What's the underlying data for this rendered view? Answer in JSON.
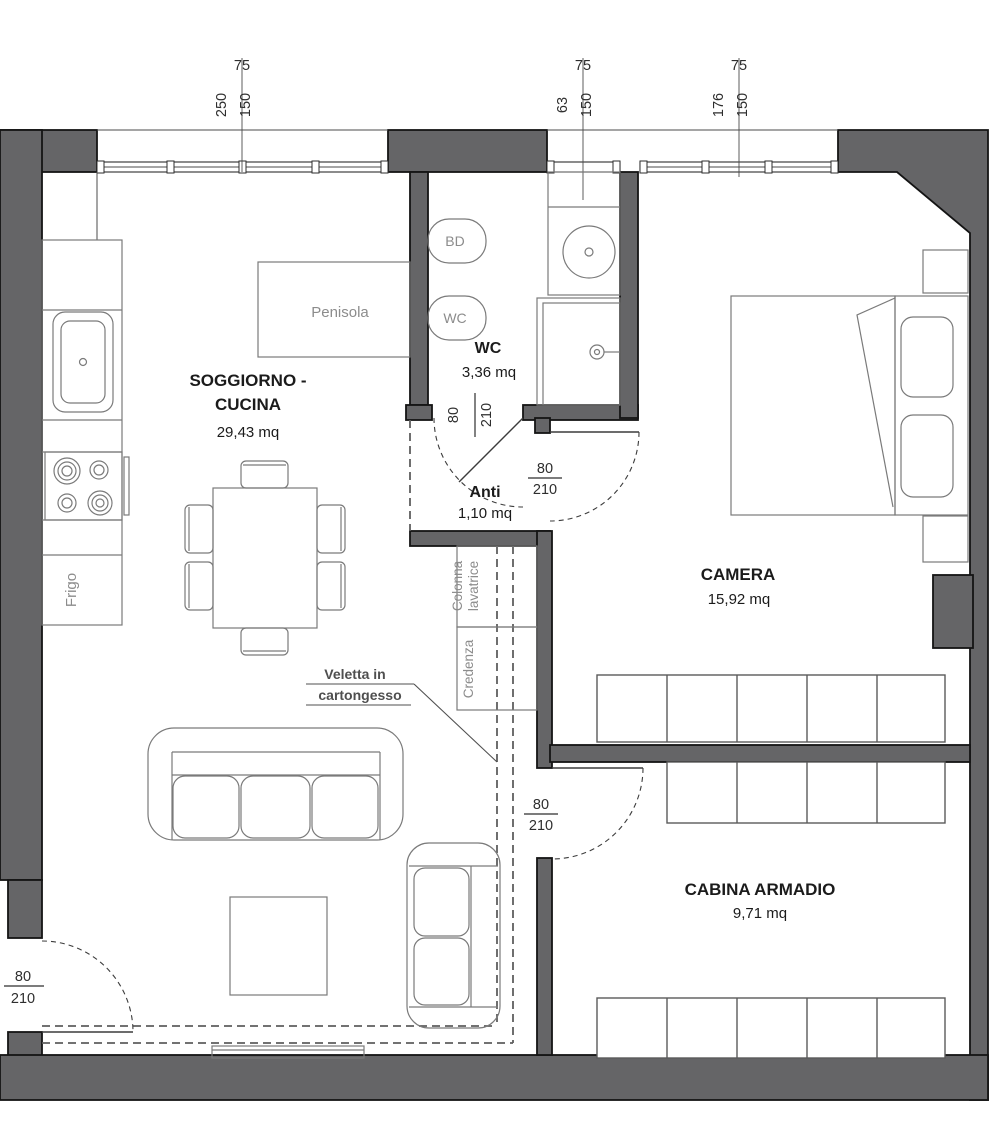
{
  "rooms": {
    "soggiorno": {
      "name_line1": "SOGGIORNO -",
      "name_line2": "CUCINA",
      "area": "29,43 mq"
    },
    "wc": {
      "name": "WC",
      "area": "3,36 mq"
    },
    "anti": {
      "name": "Anti",
      "area": "1,10 mq"
    },
    "camera": {
      "name": "CAMERA",
      "area": "15,92 mq"
    },
    "cabina_armadio": {
      "name": "CABINA ARMADIO",
      "area": "9,71 mq"
    }
  },
  "furniture_labels": {
    "penisola": "Penisola",
    "frigo": "Frigo",
    "colonna_line1": "Colonna",
    "colonna_line2": "lavatrice",
    "credenza": "Credenza"
  },
  "fixture_labels": {
    "bidet": "BD",
    "toilet": "WC"
  },
  "annotations": {
    "veletta_line1": "Veletta in",
    "veletta_line2": "cartongesso"
  },
  "dimensions": {
    "window_soggiorno": {
      "height_label": "75",
      "width": "250",
      "sill": "150"
    },
    "window_wc": {
      "height_label": "75",
      "width": "63",
      "sill": "150"
    },
    "window_camera": {
      "height_label": "75",
      "width": "176",
      "sill": "150"
    },
    "door_wc": {
      "width": "80",
      "height": "210"
    },
    "door_camera": {
      "width": "80",
      "height": "210"
    },
    "door_cabina": {
      "width": "80",
      "height": "210"
    },
    "door_entrance": {
      "width": "80",
      "height": "210"
    }
  },
  "colors": {
    "wall": "#656567",
    "outline": "#1b1b1b",
    "furniture_line": "#7a7a7a",
    "label_gray": "#8c8c8c",
    "dashed_line": "#5f5f5f",
    "background": "#ffffff"
  }
}
